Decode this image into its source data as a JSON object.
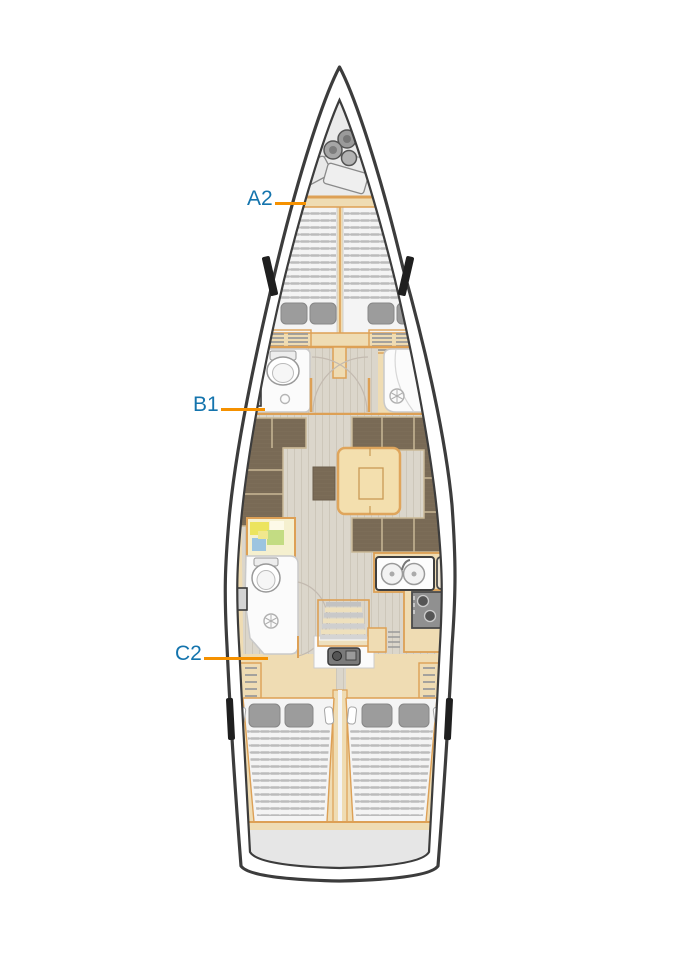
{
  "diagram": {
    "title": "sailing-yacht-interior-deck-plan",
    "labels": [
      {
        "id": "a2",
        "text": "A2",
        "target": "forward-cabin"
      },
      {
        "id": "b1",
        "text": "B1",
        "target": "forward-bathroom"
      },
      {
        "id": "c2",
        "text": "C2",
        "target": "aft-port-cabin"
      }
    ],
    "colors": {
      "label_text": "#1474ad",
      "label_line": "#f59100",
      "hull_line": "#3c3c3c",
      "wood": "#efdcb3",
      "wood_edge": "#dda055",
      "upholstery": "#7d6e5a",
      "upholstery_dark": "#73644f",
      "floor": "#dbd6cb",
      "floor_line": "#cdc7ba",
      "mattress": "#f4f4f4",
      "slat": "#bcbcbc",
      "pillow": "#9c9c9c",
      "locker": "#ebebeb",
      "stern": "#e6e6e6",
      "white_fixture": "#fbfbfb",
      "fixture_edge": "#c9c9c9",
      "appliance_dark": "#8f8f8f",
      "window_black": "#1f1f1f",
      "map_yellow": "#ece45e",
      "map_green": "#c3dc83",
      "map_blue": "#9cc4e0"
    }
  }
}
